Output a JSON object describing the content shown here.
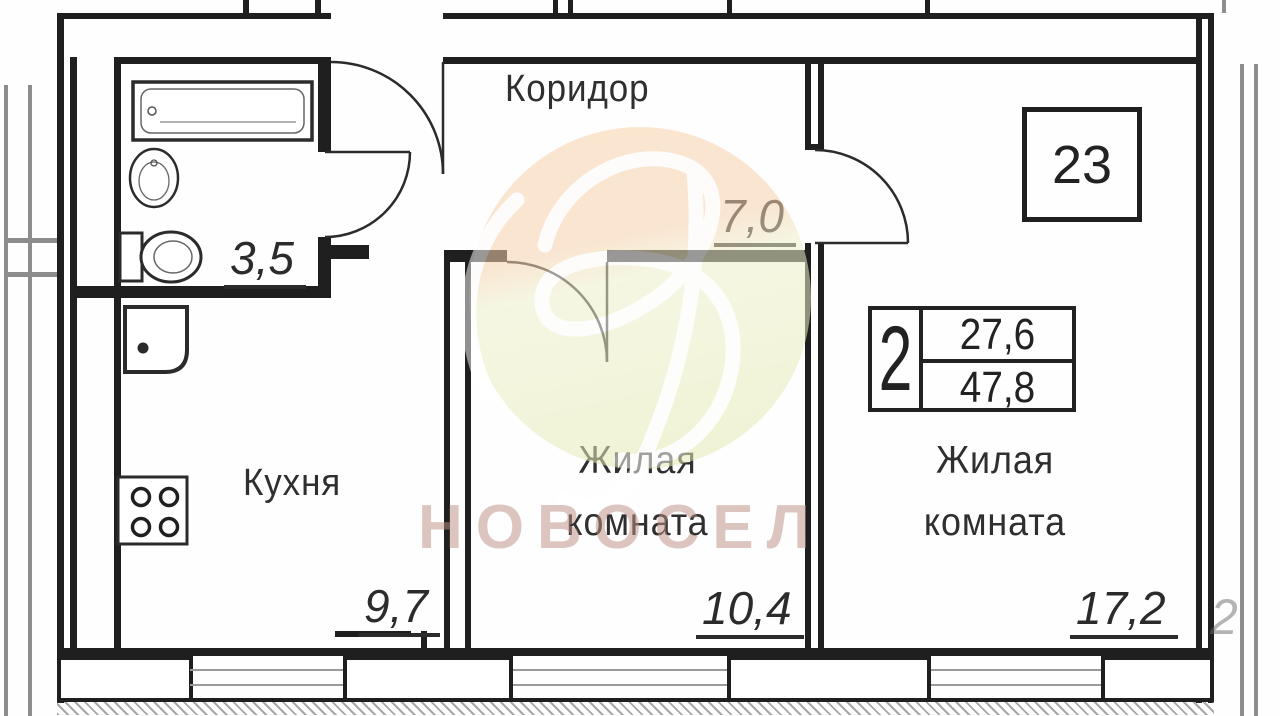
{
  "unit": {
    "number": "23",
    "rooms_count": "2",
    "living_area_sqm": "27,6",
    "total_area_sqm": "47,8"
  },
  "rooms": {
    "corridor": {
      "name": "Коридор",
      "area_sqm": "7,0"
    },
    "bathroom": {
      "area_sqm": "3,5",
      "fixtures": [
        "bathtub-icon",
        "washbasin-icon",
        "toilet-icon"
      ]
    },
    "kitchen": {
      "name": "Кухня",
      "area_sqm": "9,7",
      "fixtures": [
        "kitchen-sink-icon",
        "stove-icon"
      ]
    },
    "living_room_1": {
      "name_line1": "Жилая",
      "name_line2": "комната",
      "area_sqm": "10,4"
    },
    "living_room_2": {
      "name_line1": "Жилая",
      "name_line2": "комната",
      "area_sqm": "17,2"
    }
  },
  "watermark": {
    "agency_name": "НОВОСЕЛ",
    "text_color": "#bd9085",
    "logo_top_color": "#f8d3a9",
    "logo_bottom_color": "#e7ebb8"
  },
  "artifacts": {
    "clipped_digit": "2"
  },
  "line_color": "#1f1f1f"
}
